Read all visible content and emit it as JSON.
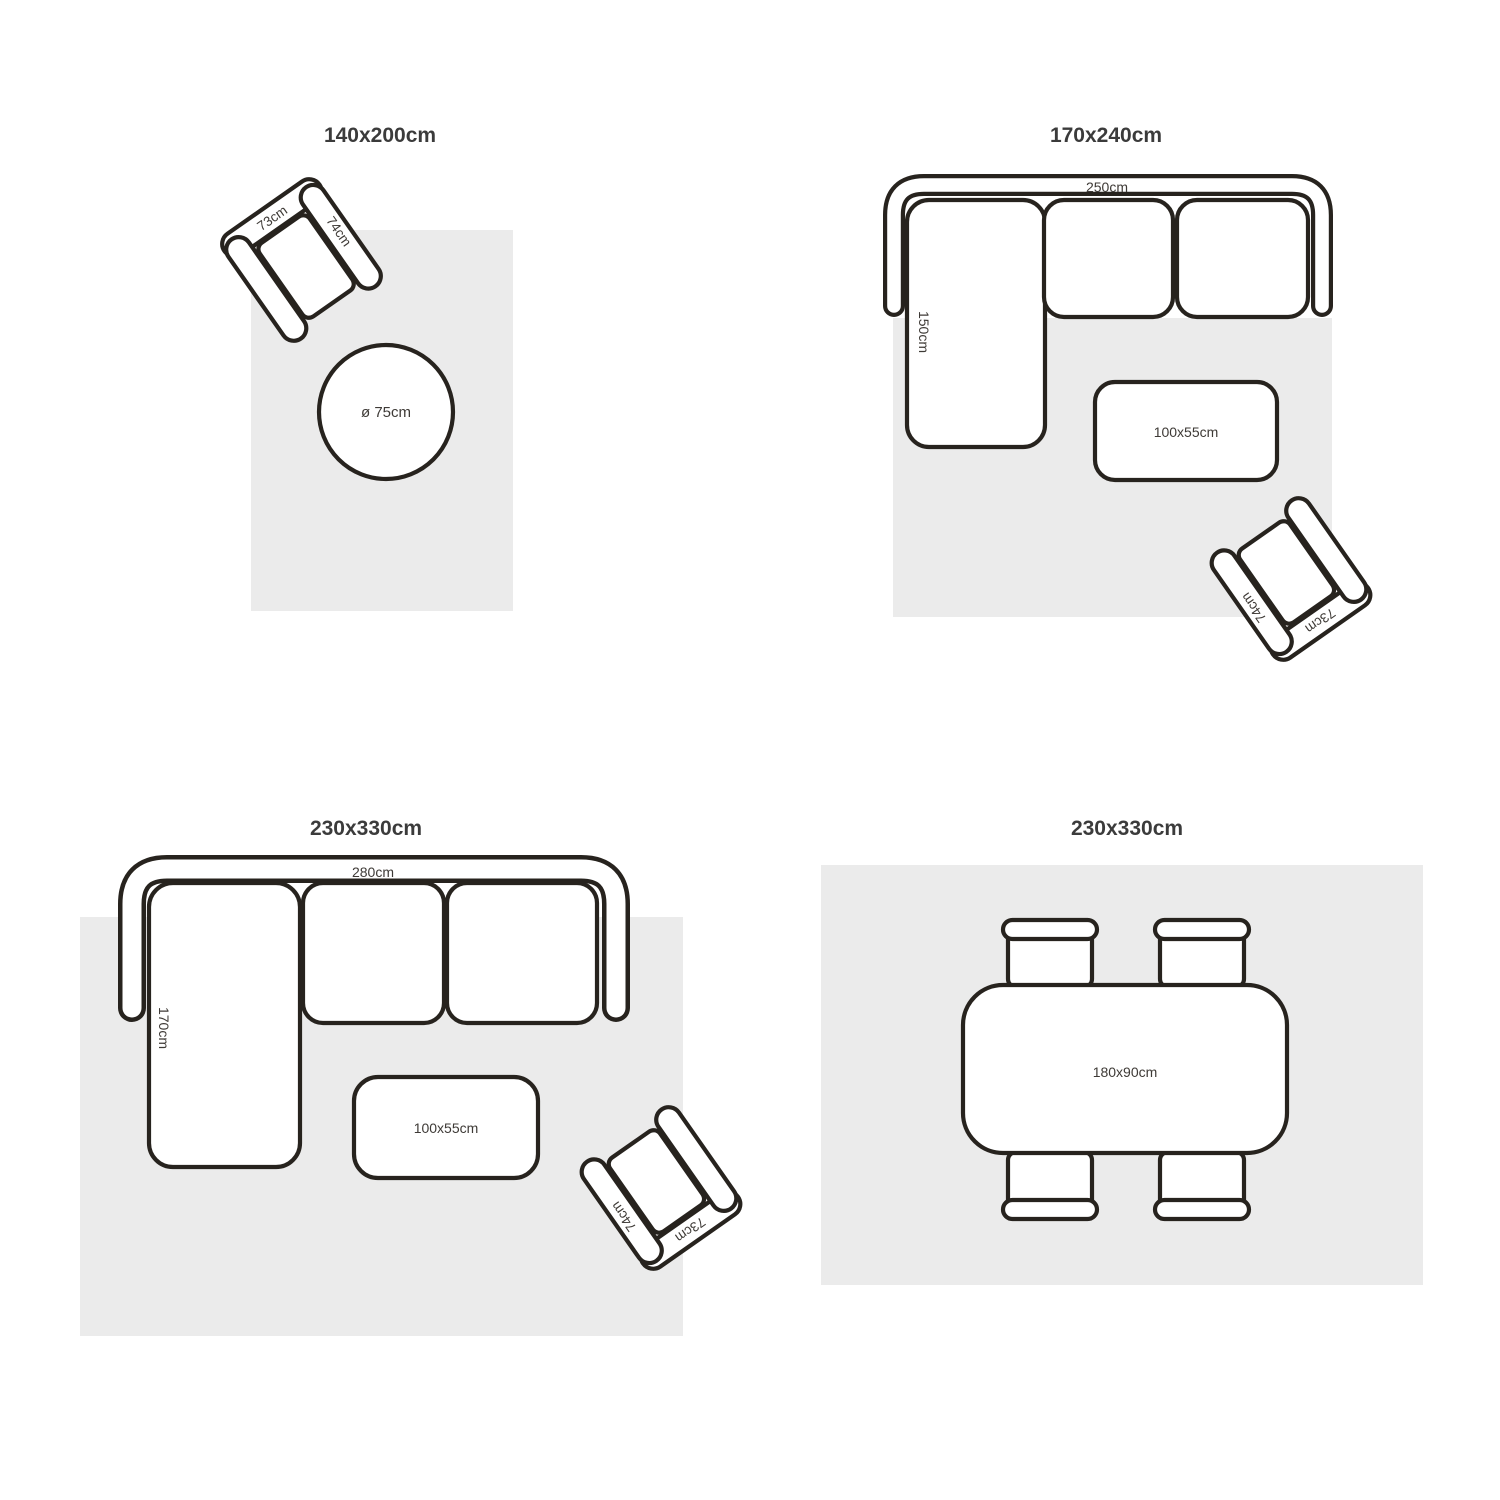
{
  "colors": {
    "background": "#ffffff",
    "rug": "#ebebeb",
    "furniture_outline": "#27231e",
    "furniture_fill": "#ffffff",
    "title_text": "#3b3b3b",
    "dimension_text": "#3e3a36"
  },
  "armchair": {
    "back_label": "73cm",
    "arm_label": "74cm"
  },
  "quadrants": {
    "q1": {
      "title": "140x200cm",
      "side_table_label": "ø 75cm"
    },
    "q2": {
      "title": "170x240cm",
      "sofa_width_label": "250cm",
      "sofa_depth_label": "150cm",
      "coffee_table_label": "100x55cm"
    },
    "q3": {
      "title": "230x330cm",
      "sofa_width_label": "280cm",
      "sofa_depth_label": "170cm",
      "coffee_table_label": "100x55cm"
    },
    "q4": {
      "title": "230x330cm",
      "dining_table_label": "180x90cm"
    }
  }
}
